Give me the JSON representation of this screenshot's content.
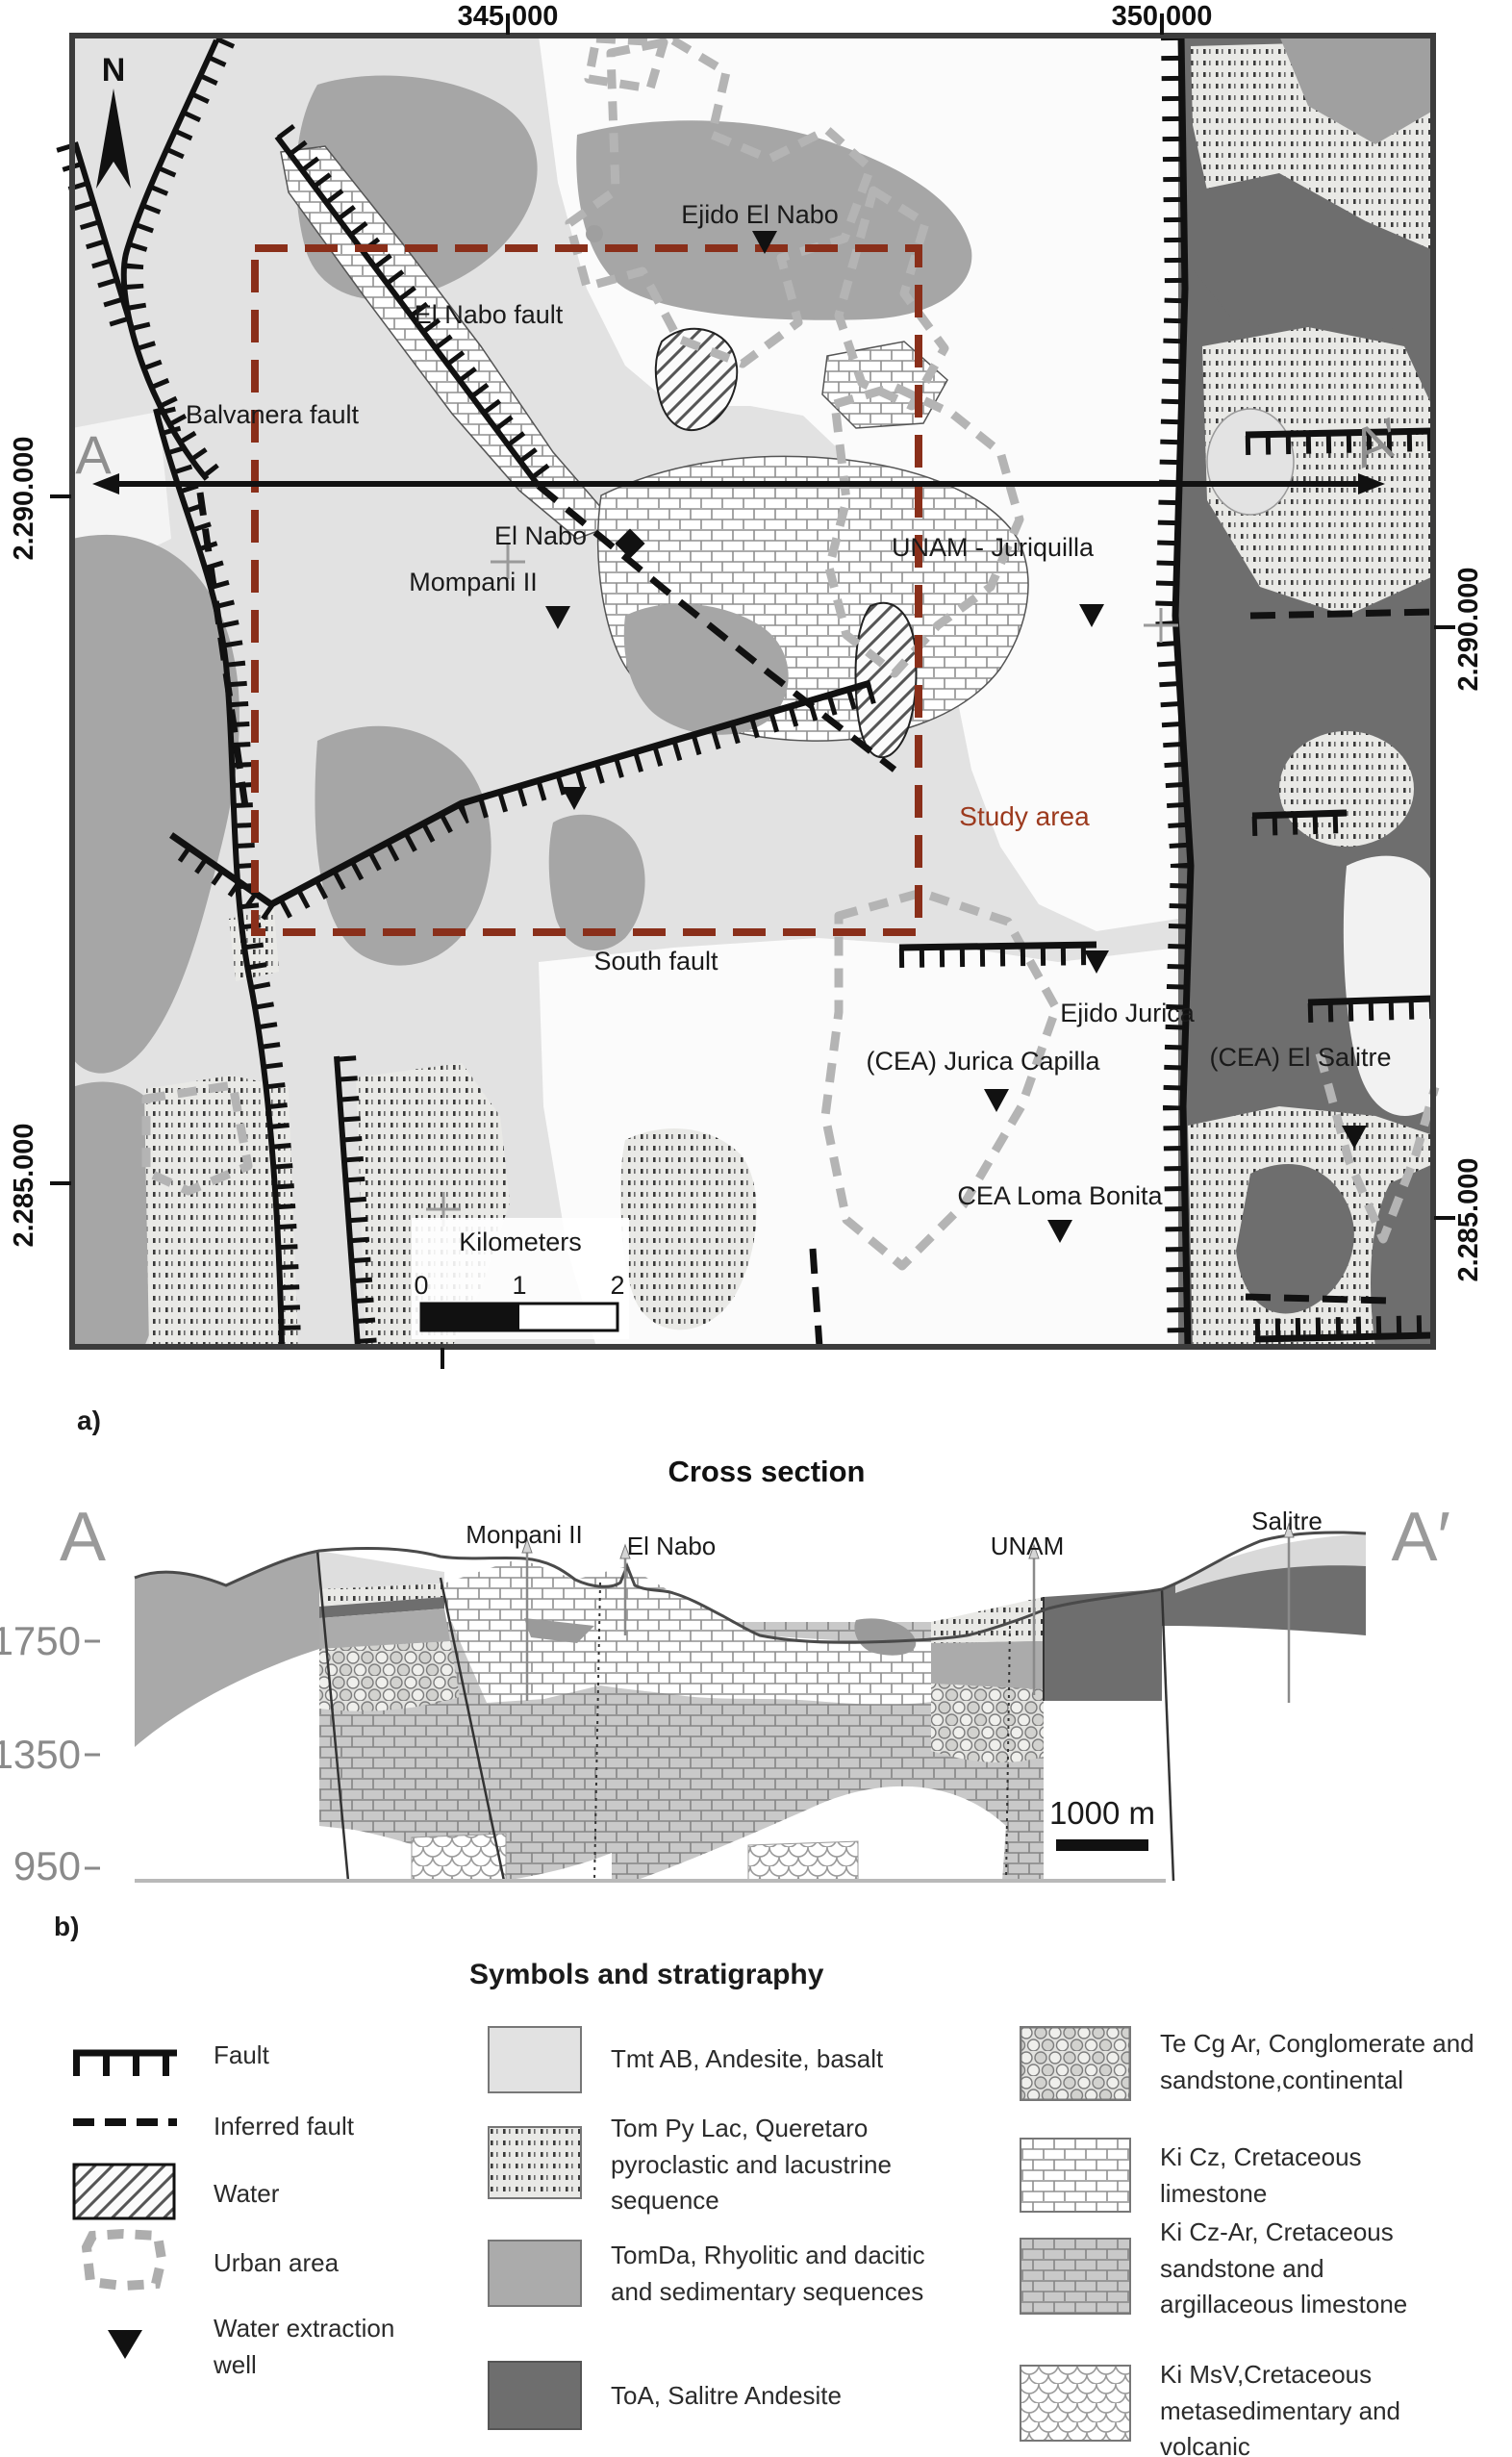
{
  "panels": {
    "a": "a)",
    "b": "b)"
  },
  "map": {
    "top_ticks": [
      "345.000",
      "350.000"
    ],
    "side_ticks": [
      "2.290.000",
      "2.285.000"
    ],
    "north": "N",
    "section_endpoints": {
      "start": "A",
      "end": "A′"
    },
    "labels": {
      "balvanera_fault": "Balvanera fault",
      "el_nabo_fault": "El Nabo fault",
      "south_fault": "South fault",
      "study_area": "Study area"
    },
    "places": {
      "ejido_el_nabo": "Ejido El Nabo",
      "el_nabo": "El Nabo",
      "mompani_ii": "Mompani II",
      "unam_juriquilla": "UNAM - Juriquilla",
      "ejido_jurica": "Ejido Jurica",
      "jurica_capilla": "(CEA) Jurica Capilla",
      "el_salitre": "(CEA) El Salitre",
      "loma_bonita": "CEA Loma Bonita"
    },
    "scale_bar": {
      "title": "Kilometers",
      "ticks": [
        "0",
        "1",
        "2"
      ]
    },
    "colors": {
      "tmt_ab": "#e2e2e2",
      "tomda": "#a9a9a9",
      "toa": "#6e6e6e",
      "urban": "#b4b4b4",
      "study_area": "#9c3a1e"
    }
  },
  "cross_section": {
    "title": "Cross section",
    "endpoints": {
      "start": "A",
      "end": "A′"
    },
    "wells": [
      "Monpani II",
      "El Nabo",
      "UNAM",
      "Salitre"
    ],
    "elevation_ticks": [
      "1750",
      "1350",
      "950"
    ],
    "scale_label": "1000 m"
  },
  "legend": {
    "title": "Symbols and stratigraphy",
    "symbols": [
      {
        "name": "fault",
        "label": "Fault"
      },
      {
        "name": "inferred-fault",
        "label": "Inferred fault"
      },
      {
        "name": "water",
        "label": "Water"
      },
      {
        "name": "urban-area",
        "label": "Urban area"
      },
      {
        "name": "water-extraction-well",
        "label": "Water extraction well"
      }
    ],
    "units": [
      {
        "code": "tmt-ab",
        "label": "Tmt AB, Andesite, basalt"
      },
      {
        "code": "tom-py-lac",
        "label": "Tom Py Lac, Queretaro pyroclastic and lacustrine sequence"
      },
      {
        "code": "tomda",
        "label": "TomDa, Rhyolitic and dacitic and sedimentary sequences"
      },
      {
        "code": "toa",
        "label": "ToA, Salitre Andesite"
      },
      {
        "code": "te-cg-ar",
        "label": "Te Cg Ar, Conglomerate and sandstone,continental"
      },
      {
        "code": "ki-cz",
        "label": "Ki Cz, Cretaceous limestone"
      },
      {
        "code": "ki-cz-ar",
        "label": "Ki Cz-Ar, Cretaceous sandstone and argillaceous limestone"
      },
      {
        "code": "ki-msv",
        "label": "Ki MsV,Cretaceous metasedimentary and volcanic"
      }
    ]
  }
}
